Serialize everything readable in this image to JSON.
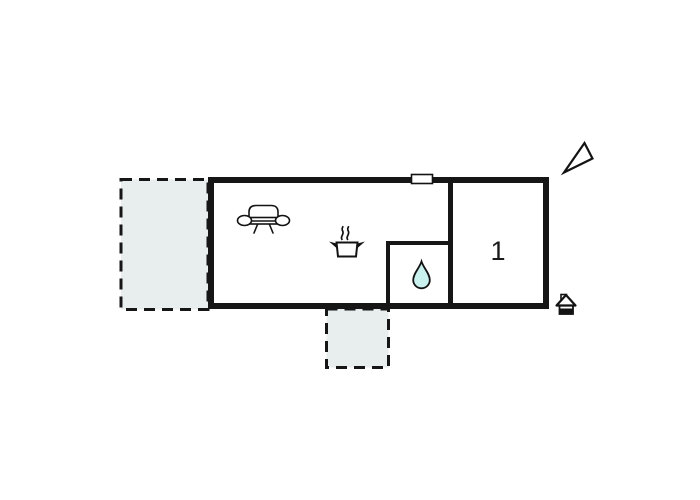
{
  "floor_plan": {
    "room_label": "1",
    "colors": {
      "background": "#ffffff",
      "wall": "#161616",
      "outdoor_area_fill": "#e8eeee",
      "water_drop_fill": "#c9f1ee"
    },
    "icons": [
      {
        "name": "north-arrow-icon"
      },
      {
        "name": "window-marker"
      },
      {
        "name": "sofa-icon"
      },
      {
        "name": "cooking-pot-icon"
      },
      {
        "name": "water-drop-icon"
      },
      {
        "name": "entrance-house-icon"
      }
    ]
  }
}
